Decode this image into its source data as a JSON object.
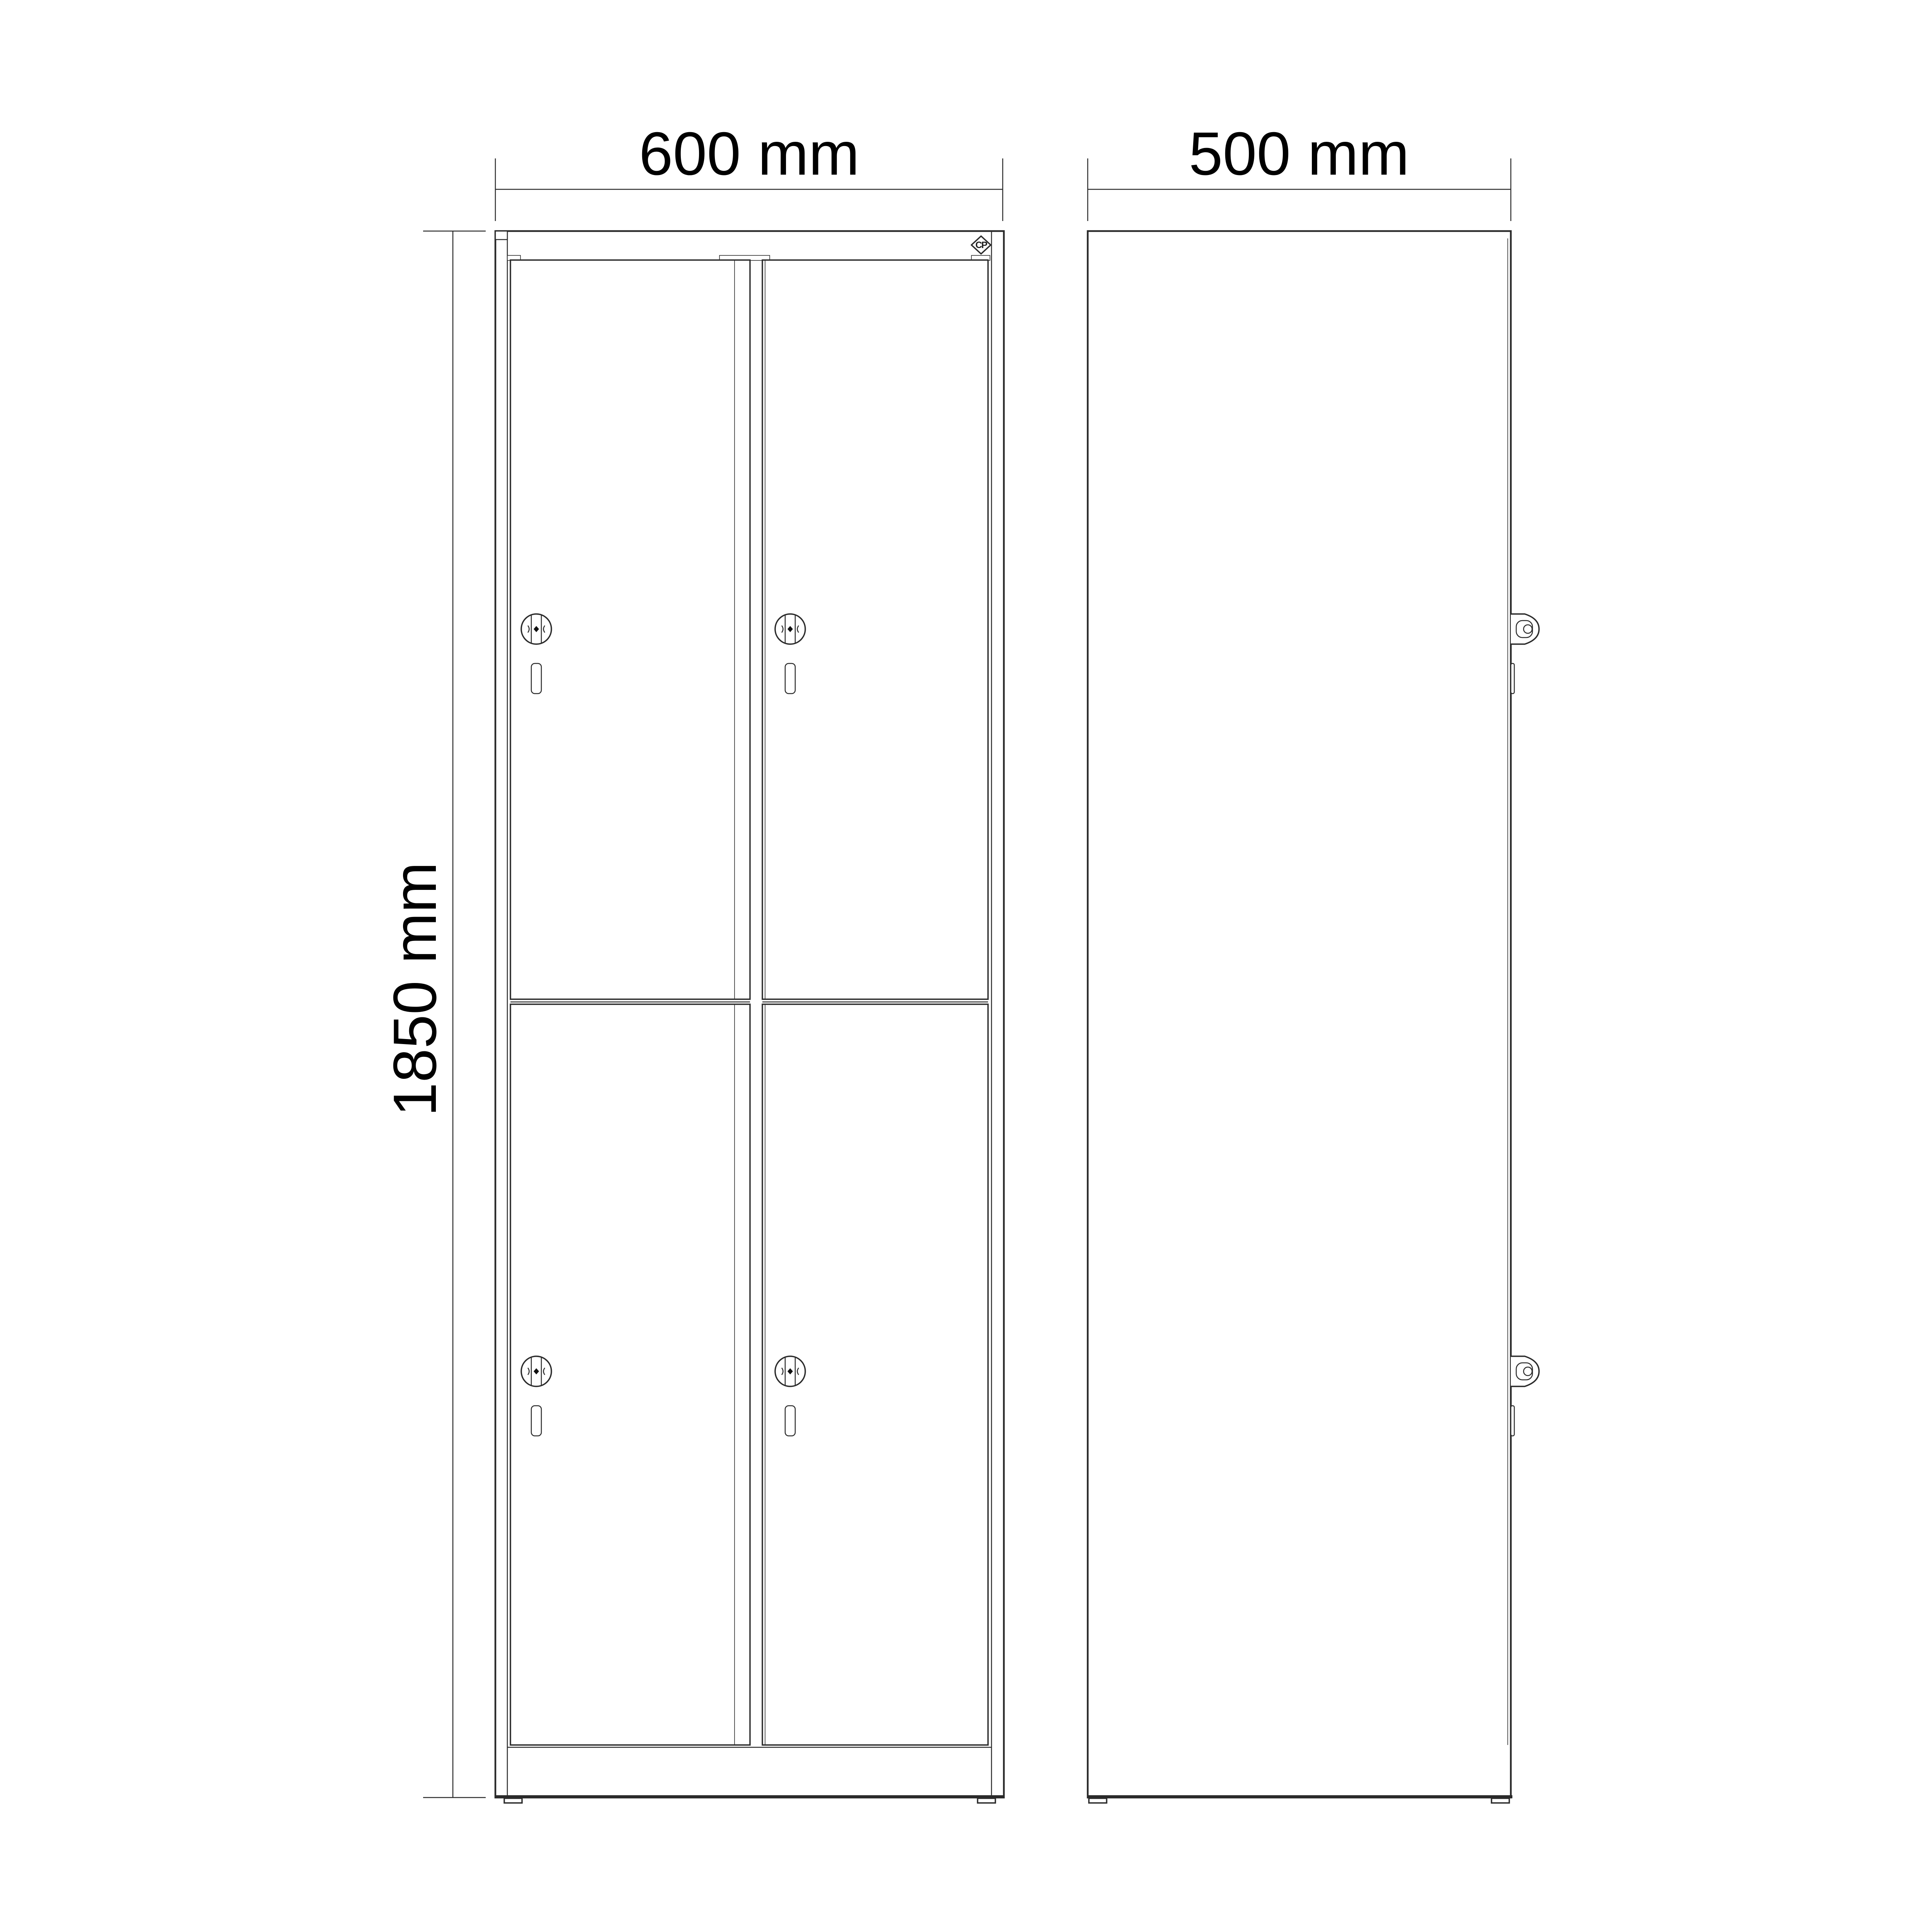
{
  "page": {
    "background": "#ffffff",
    "line_color": "#2a2a2a",
    "text_color": "#000000"
  },
  "views": {
    "front": {
      "width_dimension": "600 mm",
      "height_dimension": "1850 mm",
      "door_count": 4,
      "logo_text": "CP"
    },
    "side": {
      "depth_dimension": "500 mm"
    }
  }
}
